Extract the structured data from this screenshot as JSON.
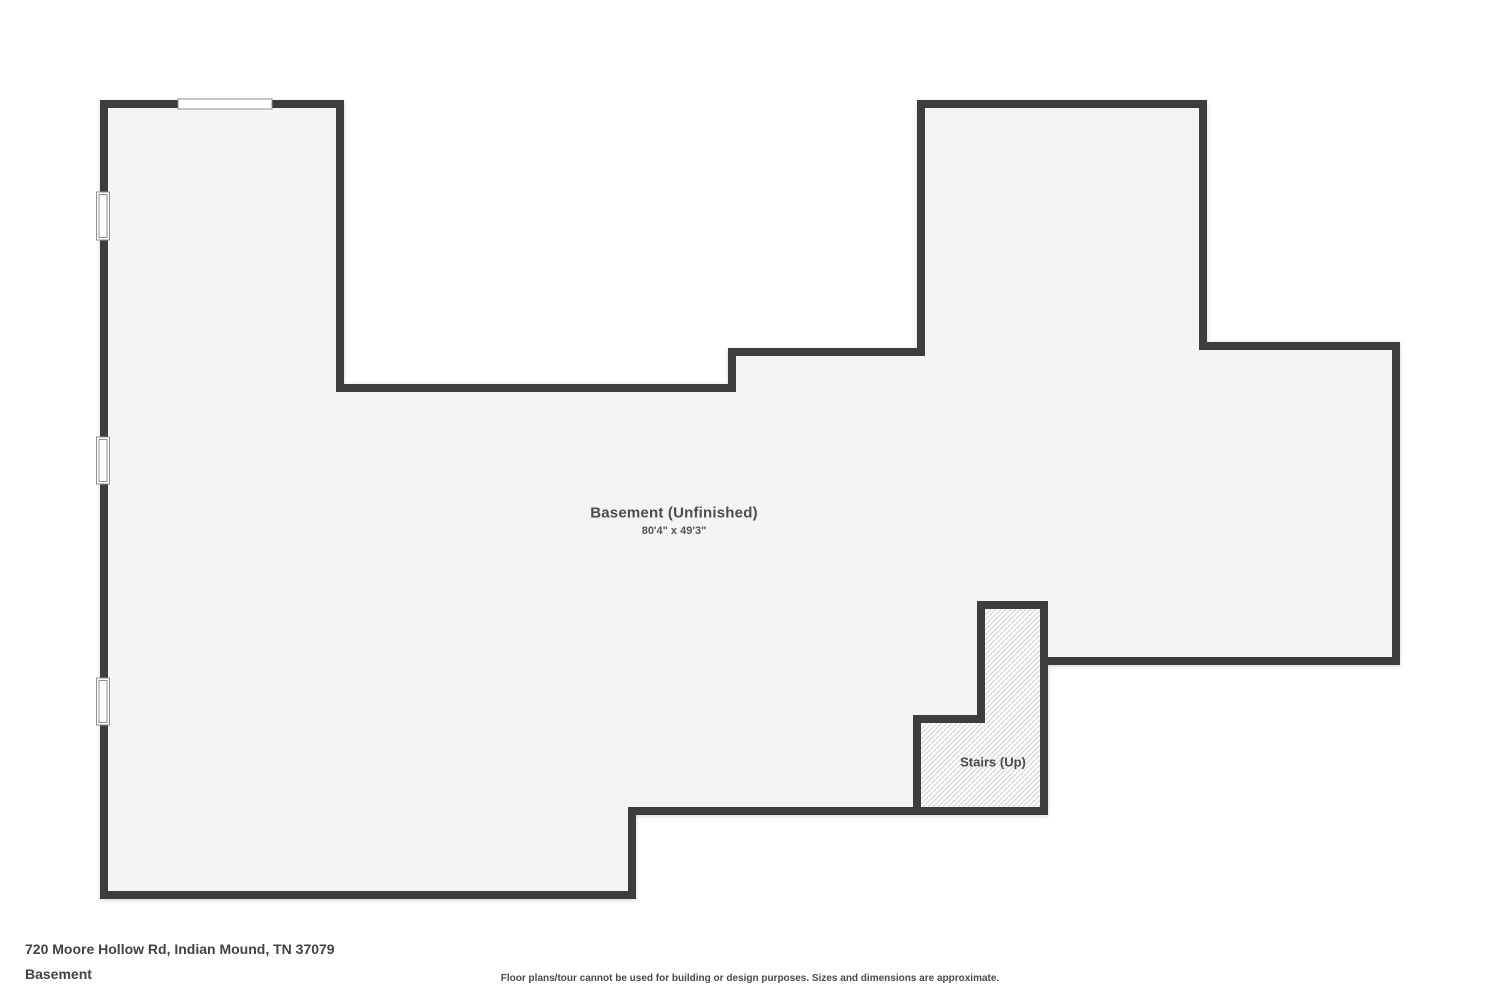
{
  "page": {
    "background": "#ffffff"
  },
  "floorplan": {
    "wall_color": "#3d3d3d",
    "wall_thickness": 8,
    "interior_fill": "#f4f4f4",
    "window_frame": "#909090",
    "window_fill": "#ffffff",
    "outline": [
      [
        104,
        104
      ],
      [
        340,
        104
      ],
      [
        340,
        388
      ],
      [
        732,
        388
      ],
      [
        732,
        352
      ],
      [
        921,
        352
      ],
      [
        921,
        104
      ],
      [
        1203,
        104
      ],
      [
        1203,
        346
      ],
      [
        1396,
        346
      ],
      [
        1396,
        661
      ],
      [
        1044,
        661
      ],
      [
        1044,
        811
      ],
      [
        632,
        811
      ],
      [
        632,
        895
      ],
      [
        104,
        895
      ]
    ],
    "stairs": {
      "points": [
        [
          981,
          605
        ],
        [
          1044,
          605
        ],
        [
          1044,
          811
        ],
        [
          917,
          811
        ],
        [
          917,
          719
        ],
        [
          981,
          719
        ]
      ],
      "fill": "#fcfcfc",
      "hatch_color": "#d2d2d2"
    },
    "windows": [
      {
        "x": 96.5,
        "y": 192,
        "w": 13,
        "h": 48,
        "style": "window"
      },
      {
        "x": 96.5,
        "y": 437,
        "w": 13,
        "h": 47,
        "style": "window"
      },
      {
        "x": 96.5,
        "y": 678,
        "w": 13,
        "h": 47,
        "style": "window"
      },
      {
        "x": 178,
        "y": 99,
        "w": 94,
        "h": 10,
        "style": "opening"
      }
    ]
  },
  "labels": {
    "room_title": {
      "text": "Basement (Unfinished)",
      "x": 674,
      "y": 513
    },
    "room_dims": {
      "text": "80'4\" x 49'3\"",
      "x": 674,
      "y": 531
    },
    "stairs": {
      "text": "Stairs (Up)",
      "x": 993,
      "y": 762
    }
  },
  "footer": {
    "address": "720 Moore Hollow Rd, Indian Mound, TN 37079",
    "floor_name": "Basement",
    "disclaimer": "Floor plans/tour cannot be used for building or design purposes. Sizes and dimensions are approximate."
  }
}
